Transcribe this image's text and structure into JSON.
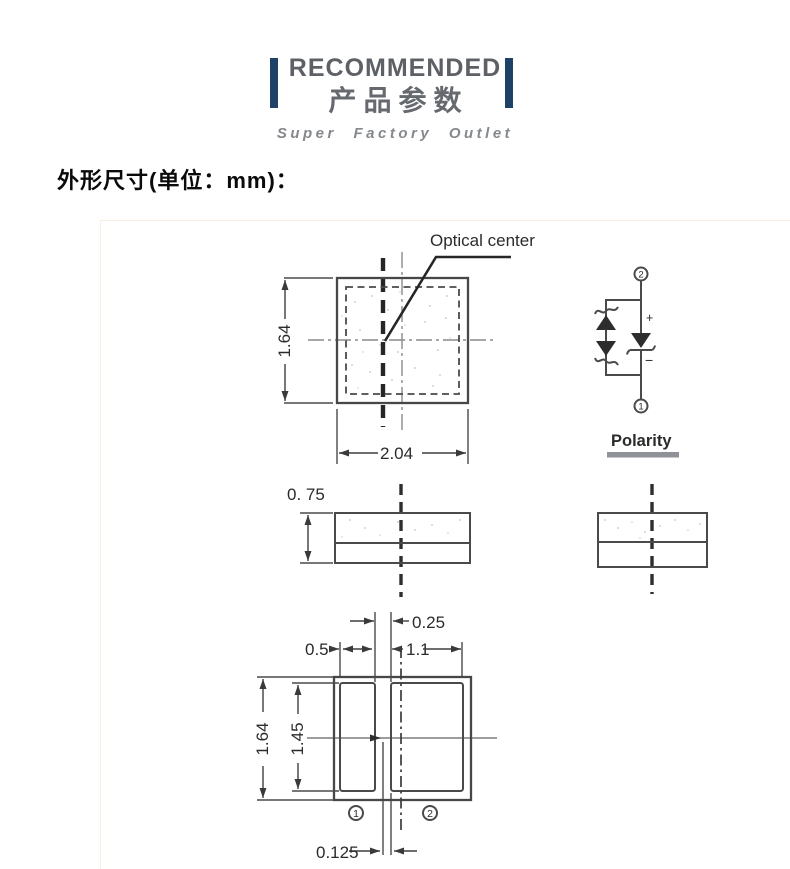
{
  "header": {
    "title_en": "RECOMMENDED",
    "title_cn": "产品参数",
    "subtitle": "Super Factory Outlet",
    "accent_color": "#1e4166"
  },
  "section_heading": "外形尺寸(单位：mm)：",
  "top_view": {
    "optical_center_label": "Optical center",
    "height_mm": "1.64",
    "width_mm": "2.04"
  },
  "polarity": {
    "label": "Polarity",
    "terminal_top": "2",
    "terminal_bottom": "1",
    "plus": "+",
    "minus": "−"
  },
  "side_view": {
    "thickness_mm": "0. 75"
  },
  "pad_layout": {
    "gap_mm": "0.25",
    "pad1_width_mm": "0.5",
    "pad2_width_mm": "1.1",
    "height_mm": "1.64",
    "pad_height_mm": "1.45",
    "center_offset_mm": "0.125",
    "pad1_label": "1",
    "pad2_label": "2"
  }
}
